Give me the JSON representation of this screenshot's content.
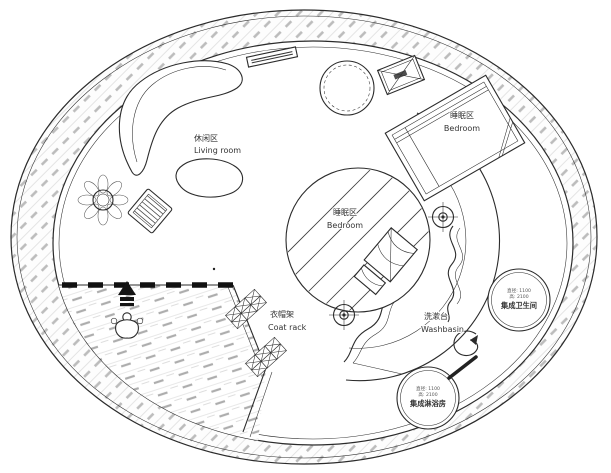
{
  "drawing_type": "circular floor plan",
  "labels": {
    "living_room_zh": "休闲区",
    "living_room_en": "Living room",
    "bedroom_top_zh": "睡眠区",
    "bedroom_top_en": "Bedroom",
    "bedroom_center_zh": "睡眠区",
    "bedroom_center_en": "Bedroom",
    "coat_rack_zh": "衣帽架",
    "coat_rack_en": "Coat rack",
    "washbasin_zh": "洗漱台",
    "washbasin_en": "Washbasin",
    "bathroom_spec1": "直径: 1100",
    "bathroom_spec2": "高: 2100",
    "bathroom_name": "集成卫生间",
    "shower_spec1": "直径: 1100",
    "shower_spec2": "高: 2100",
    "shower_name": "集成淋浴房"
  },
  "symbols": [
    "entry-arrow-icon",
    "person-figure-icon",
    "column-marker-icon",
    "spiral-arrow-icon",
    "door-handle-icon",
    "plant-icon",
    "crossed-box-symbol",
    "round-table",
    "sofa",
    "coffee-table",
    "armchair",
    "bed",
    "platform-bed",
    "coat-rack",
    "wall-shelf"
  ],
  "colors": {
    "line": "#2b2b2b",
    "wall_hatch": "#bcbcbc",
    "deck_hatch": "#adadad",
    "paper": "#ffffff",
    "text": "#333333"
  }
}
